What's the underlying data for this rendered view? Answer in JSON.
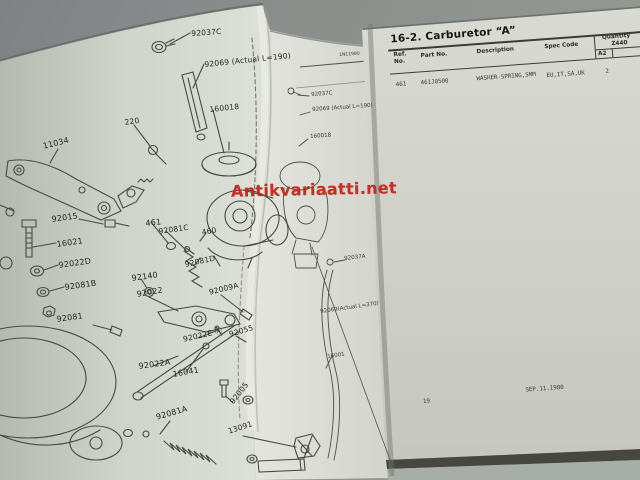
{
  "watermark": {
    "text": "Antikvariaatti.net",
    "color": "#c4261d"
  },
  "left_page": {
    "labels": [
      {
        "t": "92037C",
        "x": 191,
        "y": 29,
        "r": -4
      },
      {
        "t": "92069 (Actual L=190)",
        "x": 204,
        "y": 60,
        "r": -6
      },
      {
        "t": "160018",
        "x": 209,
        "y": 105,
        "r": -6
      },
      {
        "t": "220",
        "x": 124,
        "y": 118,
        "r": -8
      },
      {
        "t": "11034",
        "x": 42,
        "y": 142,
        "r": -14,
        "s": 8
      },
      {
        "t": "92015",
        "x": 51,
        "y": 215,
        "r": -8,
        "s": 8
      },
      {
        "t": "16021",
        "x": 56,
        "y": 240,
        "r": -8,
        "s": 8
      },
      {
        "t": "92022D",
        "x": 58,
        "y": 261,
        "r": -8,
        "s": 8
      },
      {
        "t": "92081B",
        "x": 64,
        "y": 283,
        "r": -8,
        "s": 8
      },
      {
        "t": "92081",
        "x": 56,
        "y": 315,
        "r": -8,
        "s": 8
      },
      {
        "t": "461",
        "x": 145,
        "y": 219,
        "r": -6,
        "s": 8
      },
      {
        "t": "92081C",
        "x": 158,
        "y": 227,
        "r": -8
      },
      {
        "t": "460",
        "x": 201,
        "y": 228,
        "r": -10
      },
      {
        "t": "92140",
        "x": 131,
        "y": 274,
        "r": -8,
        "s": 8
      },
      {
        "t": "92022",
        "x": 136,
        "y": 290,
        "r": -10,
        "s": 8
      },
      {
        "t": "92081D",
        "x": 184,
        "y": 260,
        "r": -12
      },
      {
        "t": "92009A",
        "x": 208,
        "y": 288,
        "r": -14
      },
      {
        "t": "92022E Ⓐ",
        "x": 182,
        "y": 334,
        "r": -13
      },
      {
        "t": "92055",
        "x": 228,
        "y": 330,
        "r": -16
      },
      {
        "t": "92022A",
        "x": 138,
        "y": 362,
        "r": -8,
        "s": 8
      },
      {
        "t": "16041",
        "x": 172,
        "y": 370,
        "r": -10,
        "s": 8
      },
      {
        "t": "92081A",
        "x": 155,
        "y": 413,
        "r": -16,
        "s": 8
      },
      {
        "t": "92005",
        "x": 228,
        "y": 400,
        "r": -52
      },
      {
        "t": "13091",
        "x": 227,
        "y": 427,
        "r": -18
      }
    ],
    "strip_labels": [
      {
        "t": "1N11980",
        "x": 339,
        "y": 53,
        "r": -4,
        "s": 4.5
      },
      {
        "t": "92037C",
        "x": 311,
        "y": 92,
        "r": -4
      },
      {
        "t": "92069 (Actual L=190)",
        "x": 312,
        "y": 107,
        "r": -4
      },
      {
        "t": "160018",
        "x": 310,
        "y": 134,
        "r": -4
      },
      {
        "t": "92037A",
        "x": 344,
        "y": 256,
        "r": -6
      },
      {
        "t": "92069(Actual L=370)",
        "x": 320,
        "y": 309,
        "r": -8
      },
      {
        "t": "16001",
        "x": 327,
        "y": 354,
        "r": -8
      }
    ]
  },
  "right_page": {
    "title": "16-2. Carburetor “A”",
    "table": {
      "headers": {
        "ref1": "Ref.",
        "ref2": "No.",
        "part": "Part No.",
        "desc": "Description",
        "spec": "Spec Code",
        "qty": "Quantity",
        "model": "Z440",
        "sub": "A2"
      },
      "rows": [
        {
          "ref": "461",
          "part": "461J0500",
          "desc": "WASHER-SPRING,5MM",
          "spec": "EU,IT,SA,UK",
          "qty": "2"
        }
      ]
    },
    "footer": {
      "page": "19",
      "date": "SEP.11.1980"
    }
  }
}
